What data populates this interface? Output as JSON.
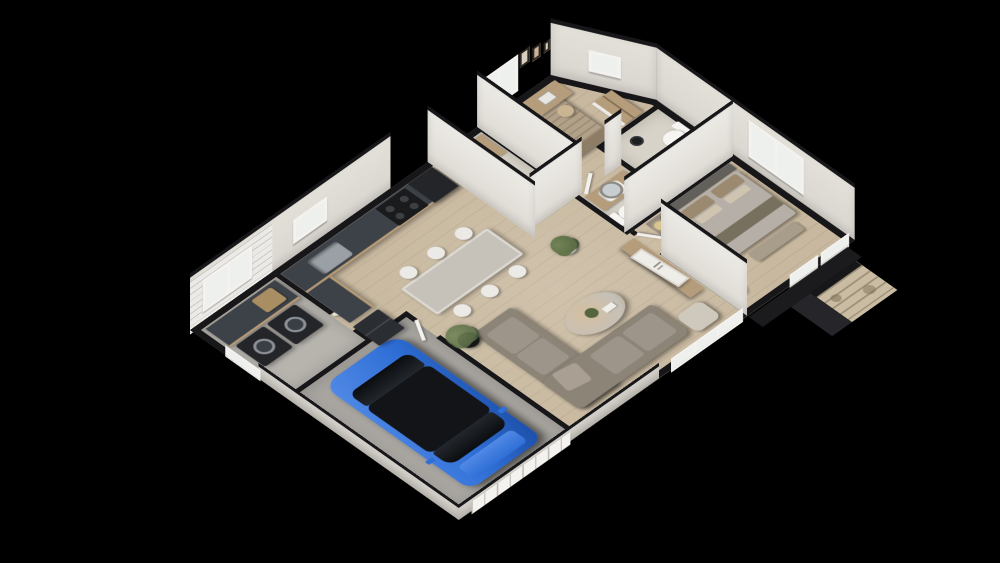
{
  "scene": {
    "kind": "isometric-3d-floorplan-cutaway-render",
    "background": "#000000",
    "view": "dollhouse cutaway, far walls full height, near walls cut low",
    "footprint": "rectangle with chamfered top-right corner"
  },
  "colors": {
    "bg": "#000000",
    "wall_face": "#d9d5cf",
    "wall_face_outer": "#c7c3bc",
    "wall_top": "#17171a",
    "brick_wall": "#eceae6",
    "floor_wood": "#c8b89f",
    "floor_tile": "#d8d3c8",
    "floor_laundry": "#b7b4ae",
    "floor_concrete": "#a8a5a0",
    "counter_top": "#3d4248",
    "cabinet_wood": "#b49a77",
    "unit_black": "#232529",
    "fridge_black": "#2a2d31",
    "sofa": "#8d8478",
    "sofa_light": "#9d958a",
    "table_top": "#c6c1b9",
    "chair_white": "#eceae6",
    "car_blue": "#2f6fd6",
    "car_blue_light": "#5189e6",
    "car_glass": "#121417",
    "duvet_guest": "#b2a189",
    "duvet_master": "#b5afa7",
    "headboard_dark": "#63605c",
    "headboard_wood": "#8a7a64",
    "pillow": "#cfc4b0",
    "wood_furniture": "#b59c7b",
    "white_furniture": "#ecebe7",
    "stone": "#c9bca2",
    "glass": "#eef0ee",
    "white_trim": "#f4f2ee",
    "plant_green": "#55663f",
    "pot_black": "#17181a",
    "porch_dark": "#1b1b1e",
    "mirror": "#c7cdd1",
    "fixture_white": "#f6f5f2",
    "lamp_shade": "#d8c590"
  },
  "rooms": [
    {
      "id": "garage",
      "contents": [
        "blue SUV",
        "sectional garage door"
      ]
    },
    {
      "id": "laundry",
      "contents": [
        "dark counter",
        "washing machine",
        "dryer",
        "laundry basket",
        "window",
        "white brick wall"
      ]
    },
    {
      "id": "kitchen",
      "contents": [
        "L-shaped counter",
        "sink",
        "black range",
        "tall black unit",
        "black refrigerator",
        "window"
      ]
    },
    {
      "id": "dining",
      "contents": [
        "long table",
        "6 white chairs"
      ]
    },
    {
      "id": "living",
      "contents": [
        "L-shaped taupe sofa",
        "oval coffee table with plant",
        "olive tree in black planter",
        "media console",
        "leaning decor sign",
        "armchair pouf"
      ]
    },
    {
      "id": "powder-room",
      "contents": [
        "toilet",
        "ladder shelf"
      ]
    },
    {
      "id": "hallway",
      "contents": [
        "potted plant"
      ]
    },
    {
      "id": "guest-bedroom",
      "contents": [
        "double bed with striped duvet",
        "desk with laptop",
        "chair",
        "drawer unit",
        "wardrobe",
        "3 wall frames",
        "window",
        "fan"
      ]
    },
    {
      "id": "bathroom",
      "contents": [
        "wood vanity",
        "white sink",
        "round mirror",
        "toilet"
      ]
    },
    {
      "id": "ensuite-wc",
      "contents": [
        "toilet",
        "small window"
      ]
    },
    {
      "id": "master-bedroom",
      "contents": [
        "double bed with grey headboard",
        "nightstand with lamp and plant",
        "tall wardrobe",
        "bench",
        "floor lamp",
        "two windows"
      ]
    },
    {
      "id": "entry",
      "contents": [
        "glazed door wall",
        "stone porch pillar with dark slab roof"
      ]
    }
  ],
  "vehicle": {
    "type": "suv",
    "body_color": "#2f6fd6",
    "roof_color": "#121417"
  },
  "counts": {
    "dining_chairs": 6,
    "wall_frames": 3,
    "windows_far_walls": 5,
    "appliances": 4
  }
}
